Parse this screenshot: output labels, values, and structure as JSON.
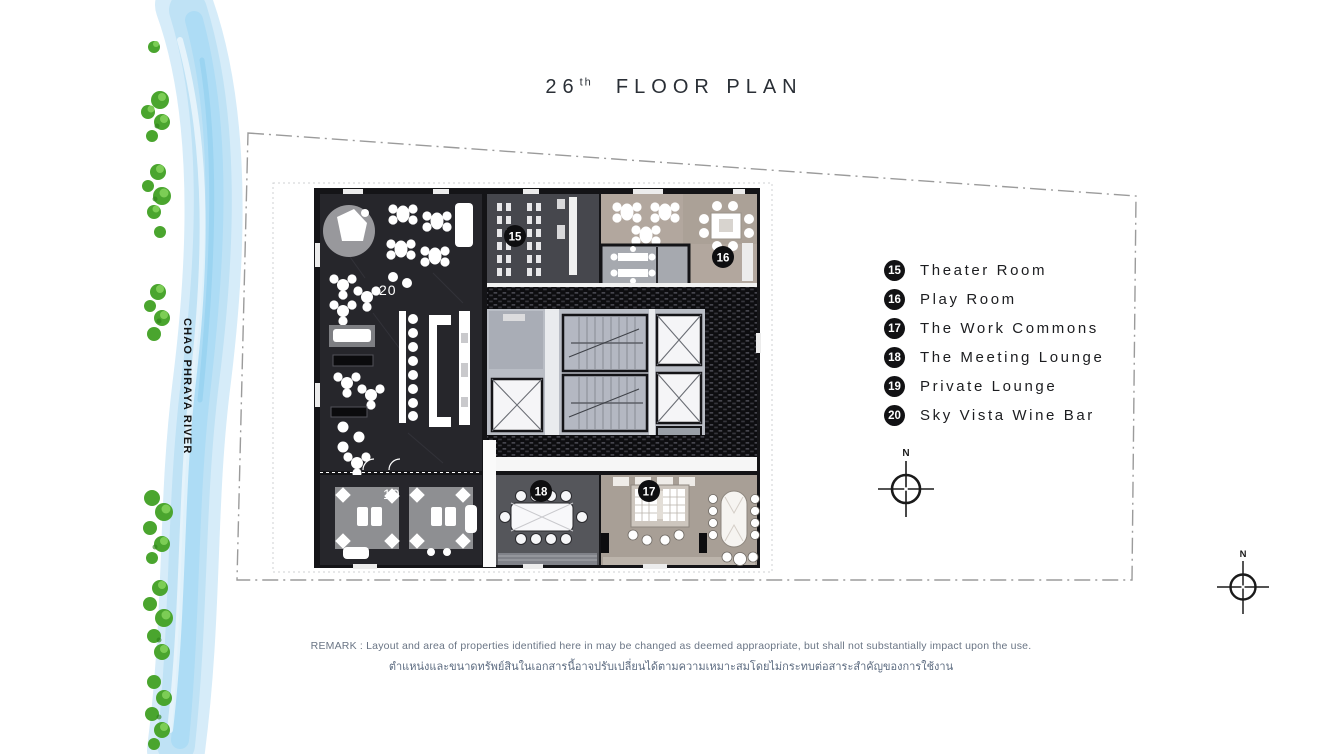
{
  "title": {
    "floor_number": "26",
    "ordinal_suffix": "th",
    "label": "FLOOR PLAN"
  },
  "river": {
    "name": "CHAO PHRAYA RIVER"
  },
  "legend": {
    "items": [
      {
        "number": "15",
        "label": "Theater Room"
      },
      {
        "number": "16",
        "label": "Play Room"
      },
      {
        "number": "17",
        "label": "The Work Commons"
      },
      {
        "number": "18",
        "label": "The Meeting Lounge"
      },
      {
        "number": "19",
        "label": "Private Lounge"
      },
      {
        "number": "20",
        "label": "Sky Vista Wine Bar"
      }
    ]
  },
  "plan_markers": {
    "theater_room": "15",
    "play_room": "16",
    "work_commons": "17",
    "meeting_lounge": "18",
    "private_lounge": "19",
    "wine_bar": "20"
  },
  "compass": {
    "north": "N"
  },
  "remark": {
    "english": "REMARK : Layout and area of properties identified here in may be changed as deemed appraopriate, but shall not substantially impact upon the use.",
    "thai": "ตำแหน่งและขนาดทรัพย์สินในเอกสารนี้อาจปรับเปลี่ยนได้ตามความเหมาะสมโดยไม่กระทบต่อสาระสำคัญของการใช้งาน"
  },
  "colors": {
    "plan_dark_floor": "#26262b",
    "plan_core_floor": "#b9bdc5",
    "plan_tan_floor": "#b2a79e",
    "hatch_band": "#0d0d10",
    "river_blue": "#bfe2f5",
    "tree_green": "#55b336",
    "marker_black": "#121214",
    "remark_text": "#5e6b80"
  }
}
